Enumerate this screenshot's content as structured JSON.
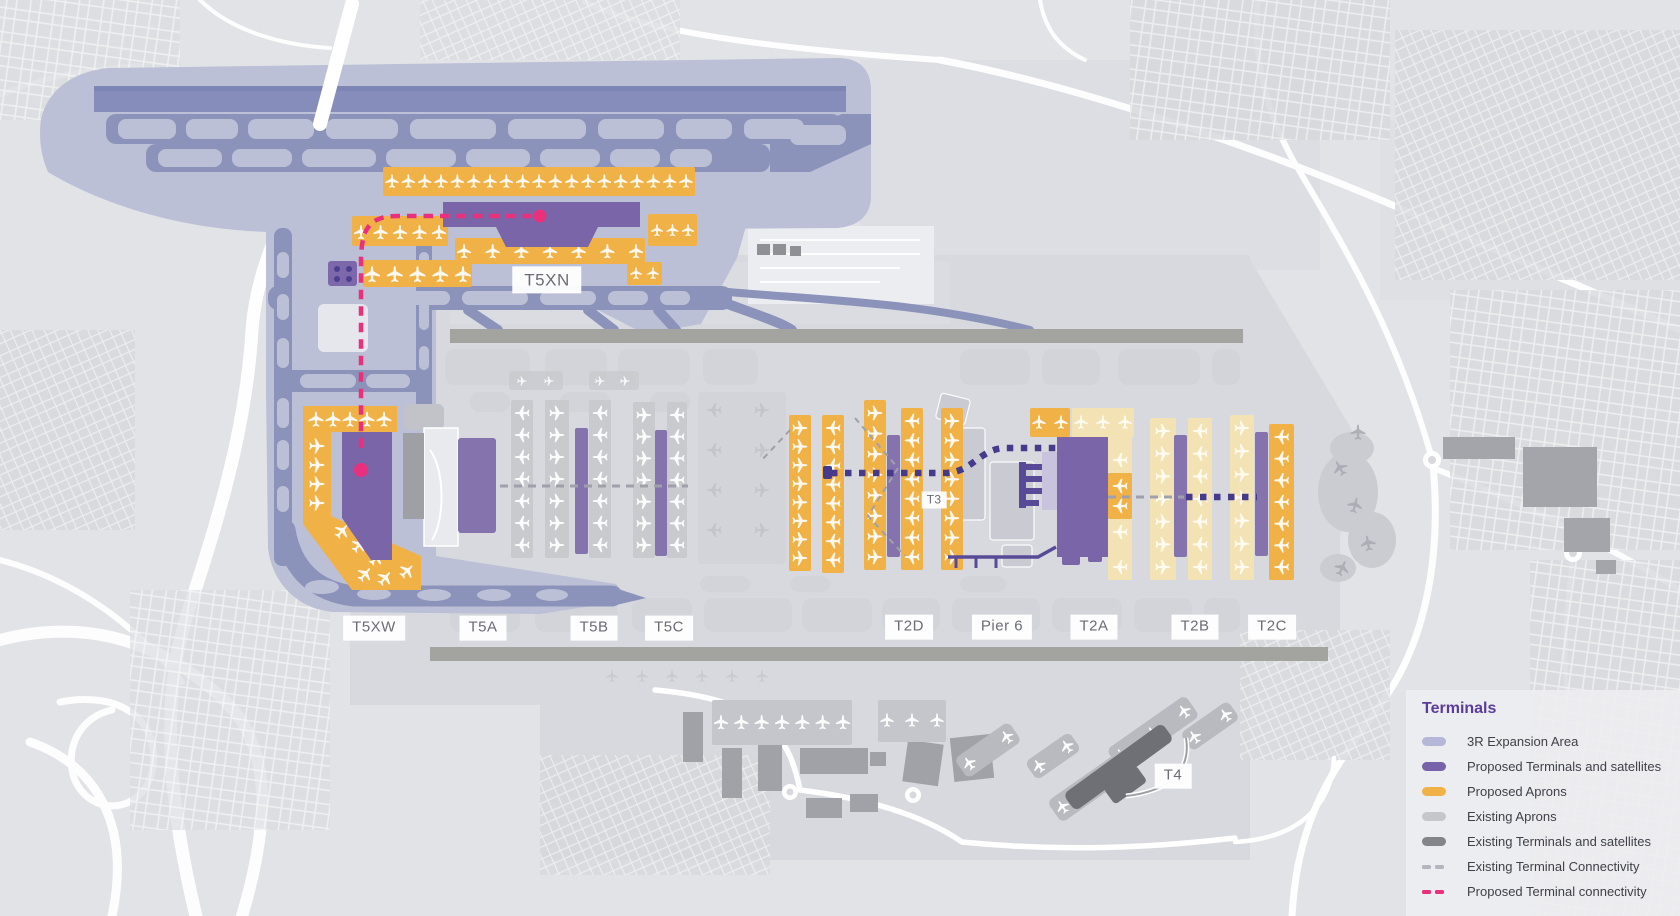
{
  "map": {
    "labels": {
      "t5xn": "T5XN",
      "t5xw": "T5XW",
      "t5a": "T5A",
      "t5b": "T5B",
      "t5c": "T5C",
      "t2d": "T2D",
      "pier6": "Pier 6",
      "t2a": "T2A",
      "t2b": "T2B",
      "t2c": "T2C",
      "t3": "T3",
      "t4": "T4"
    },
    "colors": {
      "expansion_area": "#bcc0d6",
      "taxiway": "#8c93ba",
      "proposed_terminal": "#7b65a9",
      "proposed_satellite": "#8573ae",
      "pier_structure": "#584a96",
      "proposed_apron": "#f0b246",
      "proposed_apron_pale": "#f3e3b4",
      "existing_apron": "#c9cace",
      "existing_apron_south": "#c5c6cb",
      "existing_terminal": "#6f7076",
      "existing_connectivity": "#9fa0ab",
      "proposed_connectivity": "#e8307d",
      "terminal_connectivity_dotted": "#453a8c",
      "runway": "#a3a39f"
    }
  },
  "legend": {
    "title": "Terminals",
    "title_color": "#5b3d99",
    "items": [
      {
        "label": "3R Expansion Area",
        "color": "#b5b7d8",
        "type": "pill"
      },
      {
        "label": "Proposed Terminals and satellites",
        "color": "#7862aa",
        "type": "pill"
      },
      {
        "label": "Proposed Aprons",
        "color": "#f0b246",
        "type": "pill"
      },
      {
        "label": "Existing Aprons",
        "color": "#c6c7cb",
        "type": "pill"
      },
      {
        "label": "Existing Terminals and satellites",
        "color": "#84858b",
        "type": "pill"
      },
      {
        "label": "Existing Terminal Connectivity",
        "color": "#b4b5bf",
        "type": "dash"
      },
      {
        "label": "Proposed Terminal connectivity",
        "color": "#e8307d",
        "type": "dash"
      }
    ]
  }
}
